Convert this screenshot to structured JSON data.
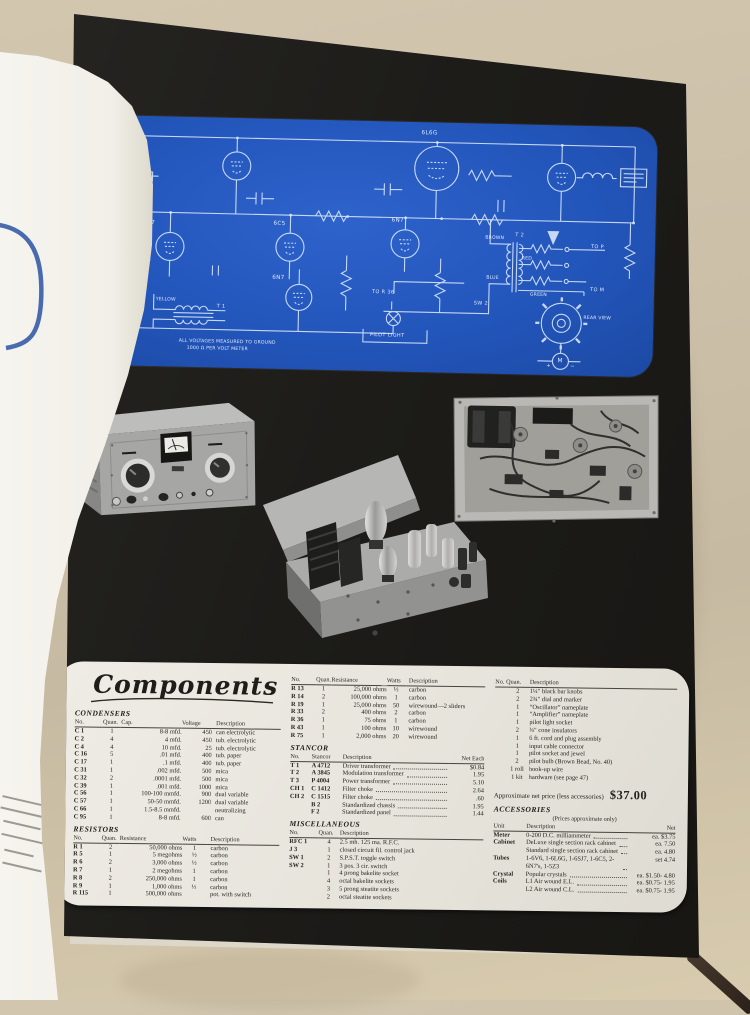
{
  "panel": {
    "title": "Components",
    "price_note": "Approximate net price (less accessories)",
    "price": "$37.00"
  },
  "schematic": {
    "labels": {
      "tube1": "6L6G",
      "tube2": "6SJ7",
      "tube3": "6C5",
      "tube4": "6N7",
      "tube5": "6N7",
      "t1": "T 1",
      "t2": "T 2",
      "sw2": "SW 2",
      "to_r36": "TO R 36",
      "to_p": "TO P",
      "to_m": "TO M",
      "pilot_light": "PILOT LIGHT",
      "rear_view": "REAR VIEW",
      "meter": "M",
      "meter_plus": "+",
      "meter_minus": "−",
      "wire_brown": "BROWN",
      "wire_red": "RED",
      "wire_blue": "BLUE",
      "wire_green": "GREEN",
      "wire_yellow": "YELLOW",
      "note1": "ALL VOLTAGES MEASURED TO GROUND",
      "note2": "1000 Ω PER VOLT METER"
    }
  },
  "components": {
    "condensers": {
      "title": "CONDENSERS",
      "headers": [
        "No.",
        "Quan.",
        "Cap.",
        "Voltage",
        "Description"
      ],
      "rows": [
        [
          "C 1",
          "1",
          "8-8 mfd.",
          "450",
          "can electrolytic"
        ],
        [
          "C 2",
          "4",
          "4 mfd.",
          "450",
          "tub. electrolytic"
        ],
        [
          "C 4",
          "4",
          "10 mfd.",
          "25",
          "tub. electrolytic"
        ],
        [
          "C 16",
          "5",
          ".01 mfd.",
          "400",
          "tub. paper"
        ],
        [
          "C 17",
          "1",
          ".1 mfd.",
          "400",
          "tub. paper"
        ],
        [
          "C 31",
          "1",
          ".002 mfd.",
          "500",
          "mica"
        ],
        [
          "C 32",
          "2",
          ".0001 mfd.",
          "500",
          "mica"
        ],
        [
          "C 39",
          "1",
          ".001 mfd.",
          "1000",
          "mica"
        ],
        [
          "C 56",
          "1",
          "100-100 mmfd.",
          "900",
          "dual variable"
        ],
        [
          "C 57",
          "1",
          "50-50 mmfd.",
          "1200",
          "dual variable"
        ],
        [
          "C 66",
          "1",
          "1.5-8.5 mmfd.",
          "",
          "neutralizing"
        ],
        [
          "C 95",
          "1",
          "8-8 mfd.",
          "600",
          "can"
        ]
      ]
    },
    "resistors": {
      "title": "RESISTORS",
      "headers": [
        "No.",
        "Quan.",
        "Resistance",
        "Watts",
        "Description"
      ],
      "rows": [
        [
          "R 1",
          "2",
          "50,000 ohms",
          "1",
          "carbon"
        ],
        [
          "R 5",
          "1",
          "5 megohms",
          "½",
          "carbon"
        ],
        [
          "R 6",
          "2",
          "3,000 ohms",
          "½",
          "carbon"
        ],
        [
          "R 7",
          "1",
          "2 megohms",
          "1",
          "carbon"
        ],
        [
          "R 8",
          "2",
          "250,000 ohms",
          "1",
          "carbon"
        ],
        [
          "R 9",
          "1",
          "1,000 ohms",
          "½",
          "carbon"
        ],
        [
          "R 115",
          "1",
          "500,000 ohms",
          "",
          "pot. with switch"
        ]
      ]
    },
    "resistors_cont": {
      "headers": [
        "No.",
        "Quan.",
        "Resistance",
        "Watts",
        "Description"
      ],
      "rows": [
        [
          "R 13",
          "1",
          "25,000 ohms",
          "½",
          "carbon"
        ],
        [
          "R 14",
          "2",
          "100,000 ohms",
          "1",
          "carbon"
        ],
        [
          "R 19",
          "1",
          "25,000 ohms",
          "50",
          "wirewound—2 sliders"
        ],
        [
          "R 33",
          "2",
          "400 ohms",
          "2",
          "carbon"
        ],
        [
          "R 36",
          "1",
          "75 ohms",
          "1",
          "carbon"
        ],
        [
          "R 43",
          "1",
          "100 ohms",
          "10",
          "wirewound"
        ],
        [
          "R 75",
          "1",
          "2,000 ohms",
          "20",
          "wirewound"
        ]
      ]
    },
    "stancor": {
      "title": "STANCOR",
      "headers": [
        "No.",
        "Stancor",
        "Description",
        "Net Each"
      ],
      "leader_col": 2,
      "rows": [
        [
          "T 1",
          "A 4712",
          "Driver transformer",
          "$0.84"
        ],
        [
          "T 2",
          "A 3845",
          "Modulation transformer",
          "1.95"
        ],
        [
          "T 3",
          "P 4004",
          "Power transformer",
          "5.10"
        ],
        [
          "CH 1",
          "C 1412",
          "Filter choke",
          "2.64"
        ],
        [
          "CH 2",
          "C 1515",
          "Filter choke",
          ".60"
        ],
        [
          "",
          "B 2",
          "Standardized chassis",
          "1.95"
        ],
        [
          "",
          "F 2",
          "Standardized panel",
          "1.44"
        ]
      ]
    },
    "miscellaneous": {
      "title": "MISCELLANEOUS",
      "headers": [
        "No.",
        "Quan.",
        "Description"
      ],
      "rows": [
        [
          "RFC 1",
          "4",
          "2.5 mh. 125 ma. R.F.C."
        ],
        [
          "J 3",
          "1",
          "closed circuit fil. control jack"
        ],
        [
          "SW 1",
          "2",
          "S.P.S.T. toggle switch"
        ],
        [
          "SW 2",
          "1",
          "3 pos. 3 cir. switch"
        ],
        [
          "",
          "1",
          "4 prong bakelite socket"
        ],
        [
          "",
          "4",
          "octal bakelite sockets"
        ],
        [
          "",
          "3",
          "5 prong steatite sockets"
        ],
        [
          "",
          "2",
          "octal steatite sockets"
        ]
      ]
    },
    "hardware": {
      "headers": [
        "No.",
        "Quan.",
        "Description"
      ],
      "rows": [
        [
          "",
          "2",
          "1¼″ black bar knobs"
        ],
        [
          "",
          "2",
          "2¾″ dial and marker"
        ],
        [
          "",
          "1",
          "“Oscillator” nameplate"
        ],
        [
          "",
          "1",
          "“Amplifier” nameplate"
        ],
        [
          "",
          "1",
          "pilot light socket"
        ],
        [
          "",
          "2",
          "¾″ cone insulators"
        ],
        [
          "",
          "1",
          "6 ft. cord and plug assembly"
        ],
        [
          "",
          "1",
          "input cable connector"
        ],
        [
          "",
          "1",
          "pilot socket and jewel"
        ],
        [
          "",
          "2",
          "pilot bulb (Brown Bead, No. 40)"
        ],
        [
          "",
          "1 roll",
          "hook-up wire"
        ],
        [
          "",
          "1 kit",
          "hardware (see page 47)"
        ]
      ]
    },
    "accessories": {
      "title": "ACCESSORIES",
      "note": "(Prices approximate only)",
      "headers": [
        "Unit",
        "Description",
        "Net"
      ],
      "leader_col": 1,
      "rows": [
        [
          "Meter",
          "0-200 D.C. milliammeter",
          "ea. $3.75"
        ],
        [
          "Cabinet",
          "DeLuxe single section rack cabinet",
          "ea. 7.50"
        ],
        [
          "",
          "Standard single section rack cabinet",
          "ea. 4.80"
        ],
        [
          "Tubes",
          "1-6V6, 1-6L6G, 1-6SJ7, 1-6C5, 2-6N7's, 1-5Z3",
          "set 4.74"
        ],
        [
          "Crystal",
          "Popular crystals",
          "ea. $1.50- 4.80"
        ],
        [
          "Coils",
          "L1 Air wound E.L.",
          "ea. $0.75- 1.95"
        ],
        [
          "",
          "L2 Air wound C.L.",
          "ea. $0.75- 1.95"
        ]
      ]
    }
  }
}
